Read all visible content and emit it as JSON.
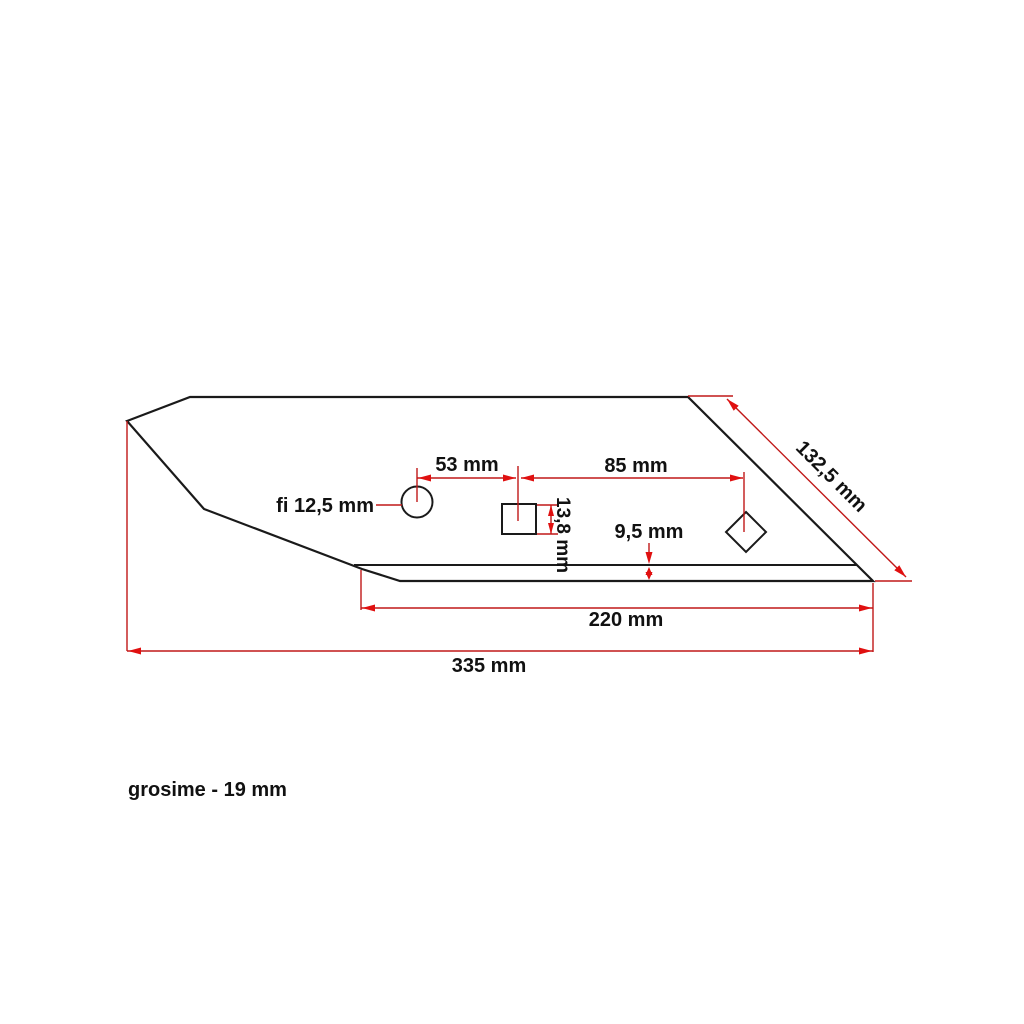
{
  "drawing": {
    "labels": {
      "hole_spacing_left": "53 mm",
      "hole_spacing_right": "85 mm",
      "round_hole_diameter": "fi 12,5 mm",
      "square_hole_height": "13,8 mm",
      "cutting_edge_offset": "9,5 mm",
      "diagonal_edge_length": "132,5 mm",
      "bottom_edge_length": "220 mm",
      "total_length": "335 mm",
      "thickness_note": "grosime - 19 mm"
    },
    "colors": {
      "outline": "#1a1a1a",
      "dimension_line": "#c01818",
      "arrowhead": "#e01010",
      "background": "#ffffff"
    }
  }
}
